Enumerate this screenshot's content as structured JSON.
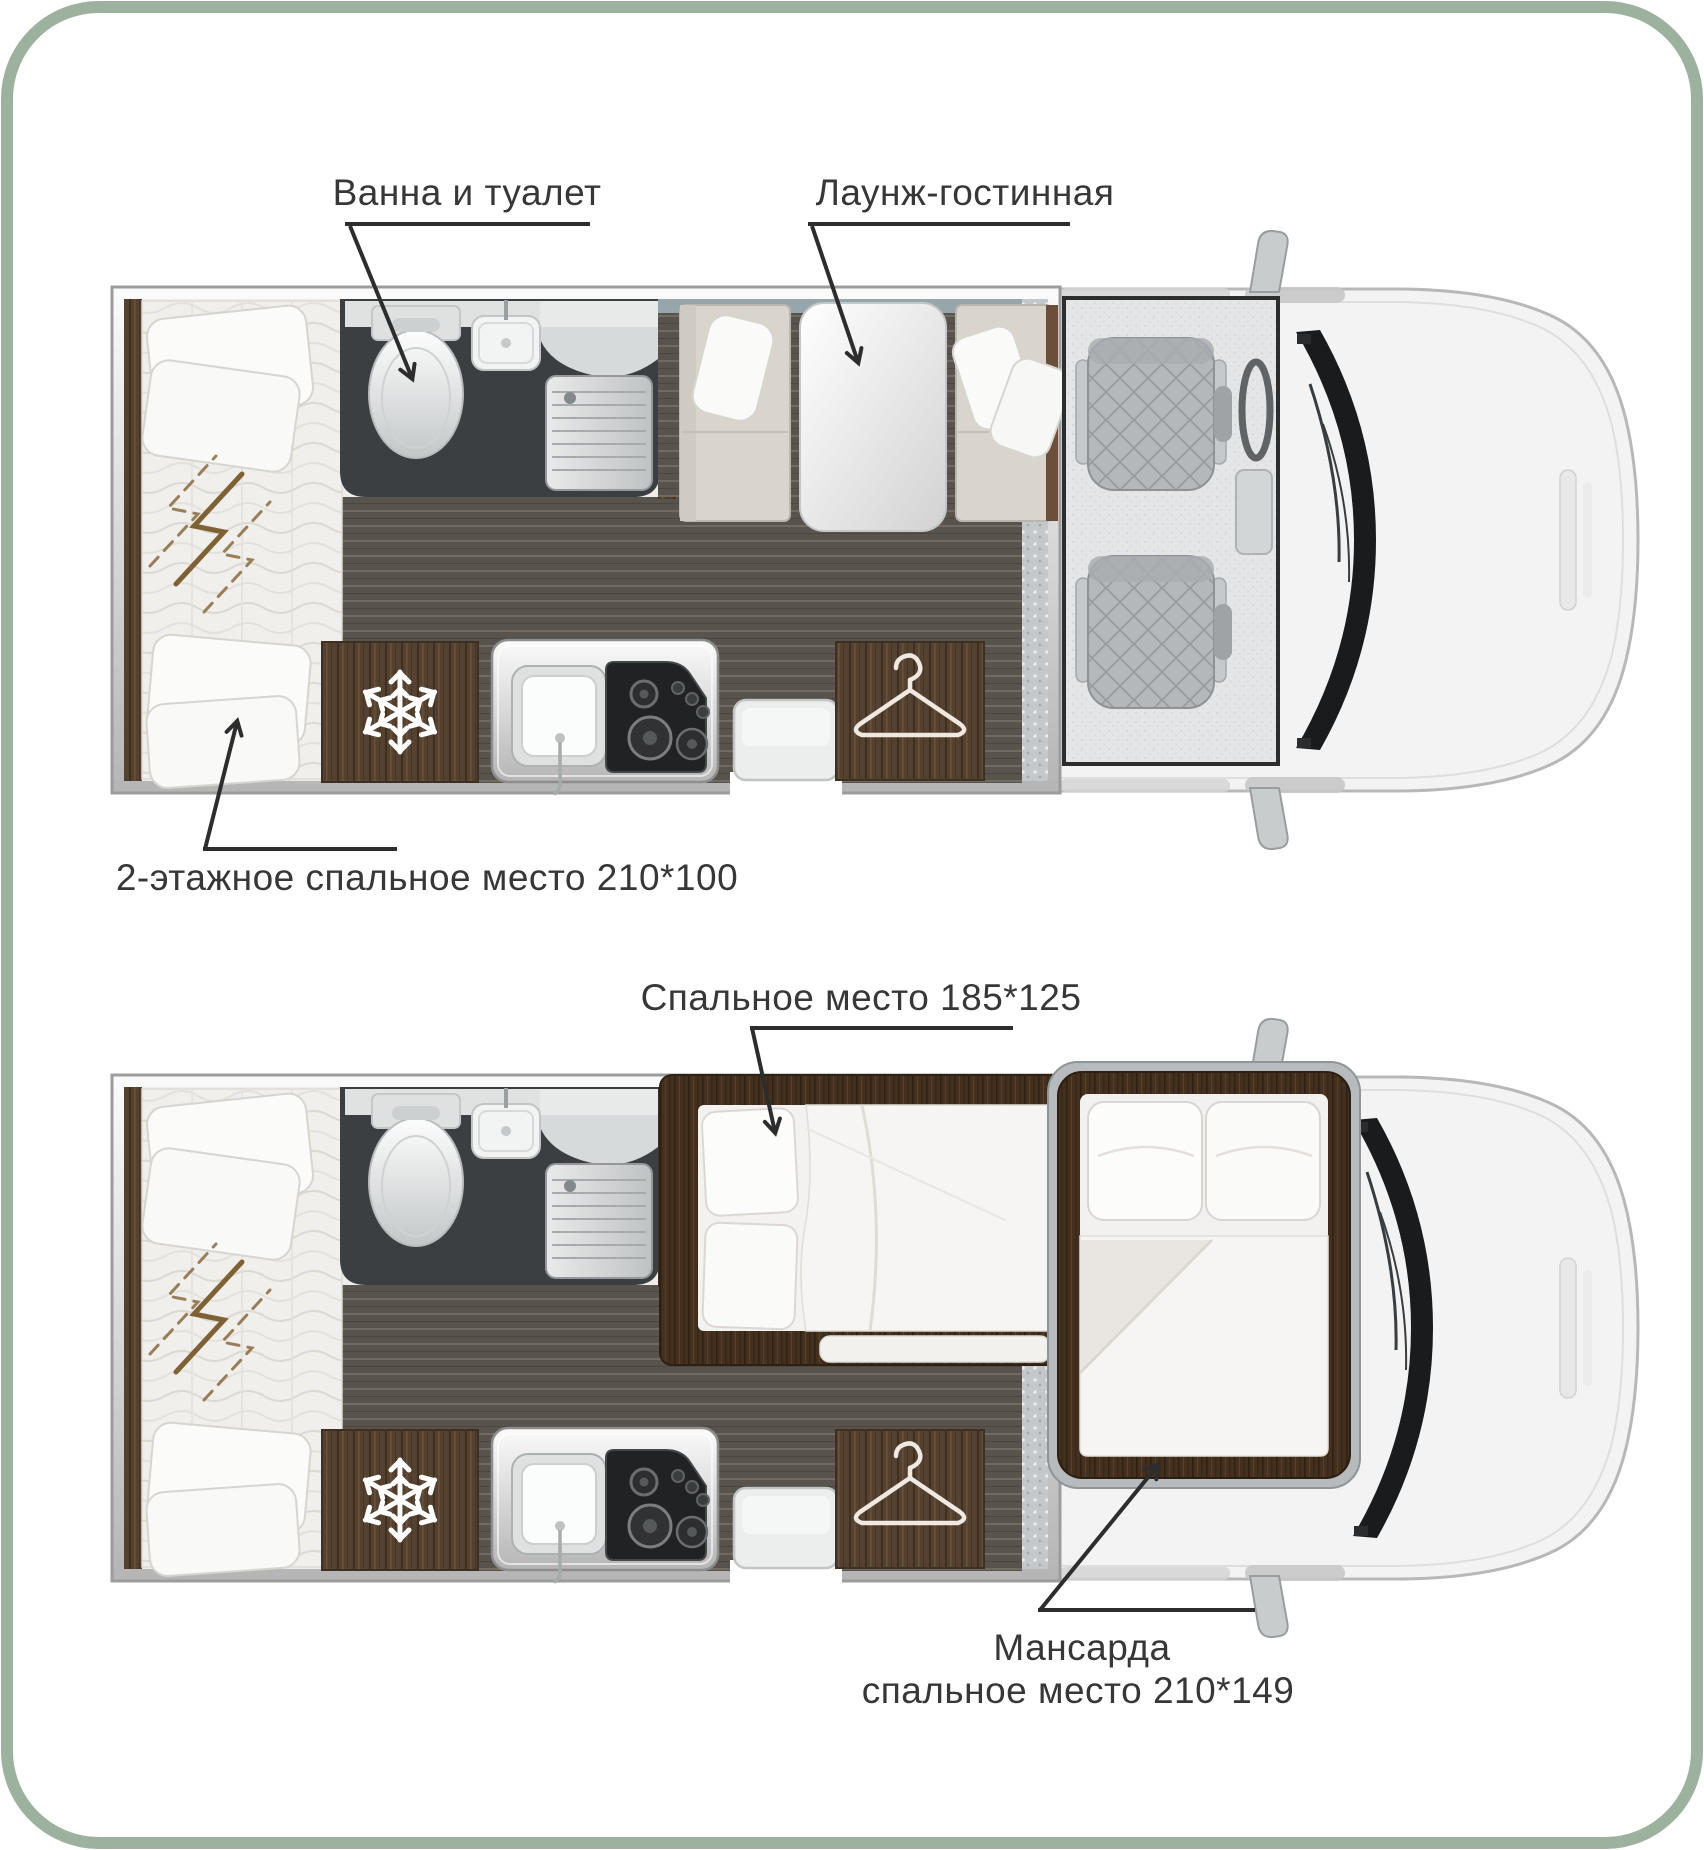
{
  "page": {
    "frame_color": "#9db19f",
    "background": "#ffffff"
  },
  "diagram": {
    "type": "rv-floorplan",
    "plans": [
      {
        "name": "day-layout",
        "labels": {
          "bath": "Ванна и туалет",
          "lounge": "Лаунж-гостинная",
          "bunk": "2-этажное спальное место 210*100"
        }
      },
      {
        "name": "night-layout",
        "labels": {
          "bed_main": "Спальное место 185*125",
          "attic_line1": "Мансарда",
          "attic_line2": "спальное место 210*149"
        }
      }
    ],
    "icons": {
      "fridge": "snowflake-icon",
      "wardrobe": "hanger-icon"
    },
    "colors": {
      "label_text": "#373737",
      "leader_line": "#2d2d2d",
      "floor": "#58534c",
      "bathroom": "#3b3f42",
      "sofa": "#d9d5cd",
      "wall_accent": "#97a5ac",
      "wood_dark": "#55412f",
      "wood_frame": "#44301f",
      "van_body": "#f3f3f3"
    }
  }
}
